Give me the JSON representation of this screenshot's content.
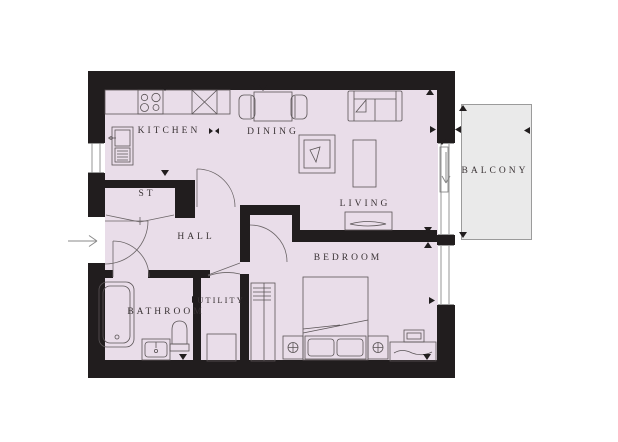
{
  "plan": {
    "type": "floorplan",
    "description": "One-bedroom apartment floor plan with balcony",
    "rooms": [
      {
        "id": "kitchen",
        "label": "KITCHEN"
      },
      {
        "id": "dining",
        "label": "DINING"
      },
      {
        "id": "living",
        "label": "LIVING"
      },
      {
        "id": "store",
        "label": "ST"
      },
      {
        "id": "hall",
        "label": "HALL"
      },
      {
        "id": "bathroom",
        "label": "BATHROOM"
      },
      {
        "id": "utility",
        "label": "UTILITY"
      },
      {
        "id": "bedroom",
        "label": "BEDROOM"
      },
      {
        "id": "balcony",
        "label": "BALCONY"
      }
    ],
    "colors": {
      "floor_fill": "#e9dde9",
      "wall": "#211d1e",
      "balcony_fill": "#eaeaea",
      "balcony_border": "#9b9b9b",
      "furniture_line": "#5a5456",
      "label_text": "#3a3335",
      "entry_arrow": "#8a8a8a"
    },
    "furniture_icons": [
      "hob-icon",
      "oven-unit-icon",
      "kitchen-sink-icon",
      "dining-table-icon",
      "dining-chair-icon",
      "sofa-icon",
      "armchair-icon",
      "coffee-table-icon",
      "tv-unit-icon",
      "bathtub-icon",
      "basin-icon",
      "toilet-icon",
      "washing-machine-icon",
      "wardrobe-icon",
      "double-bed-icon",
      "bedside-table-icon",
      "dressing-table-icon",
      "stool-icon"
    ],
    "annotations": {
      "entry": "entrance arrow on left wall",
      "balcony_access": "sliding door with direction arrow",
      "dimension_markers": "small black triangles at survey points"
    }
  }
}
